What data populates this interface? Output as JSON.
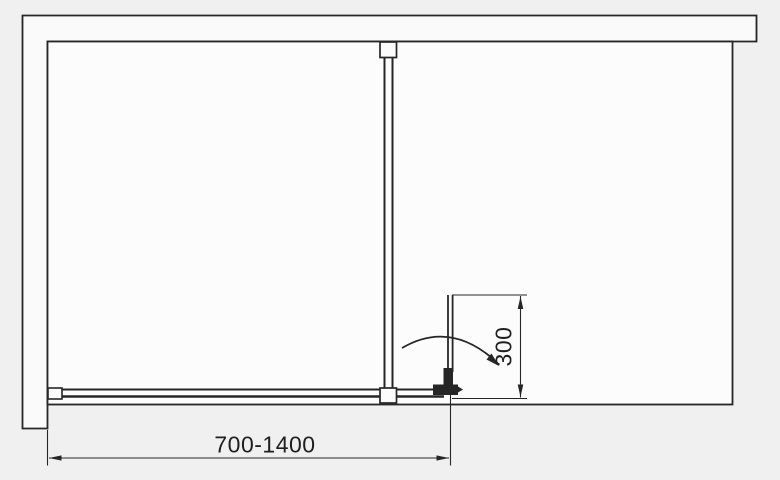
{
  "diagram": {
    "name": "shower-enclosure-plan-view",
    "type": "technical-drawing",
    "dimensions": {
      "width_label": "700-1400",
      "depth_label": "300"
    },
    "theme": {
      "bg": "#f1f0f1",
      "paper": "#fcfcfc",
      "wall": "#fafafa",
      "line": "#262626",
      "text": "#1f1f1f"
    }
  }
}
